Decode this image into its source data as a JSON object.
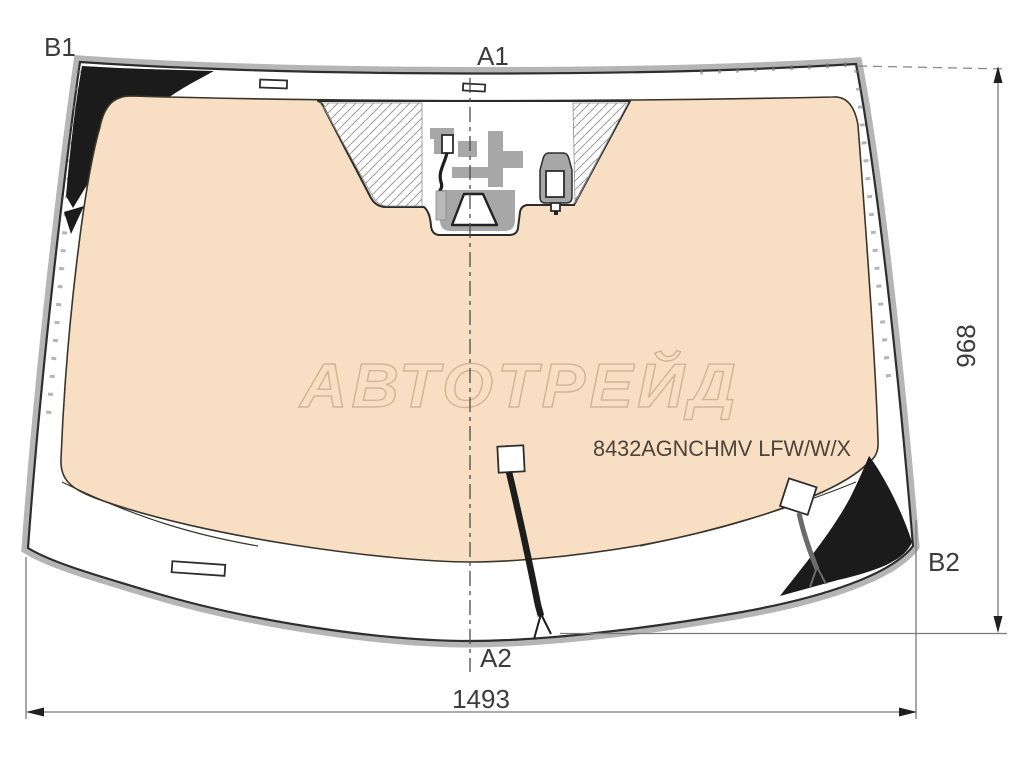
{
  "diagram": {
    "type": "windshield-schematic",
    "labels": {
      "b1": "B1",
      "a1": "A1",
      "a2": "A2",
      "b2": "B2"
    },
    "dimensions": {
      "height_mm": "968",
      "width_mm": "1493"
    },
    "part_number": "8432AGNCHMV LFW/W/X",
    "watermark": "АВТОТРЕЙД",
    "colors": {
      "glass_tint": "#f8dfc3",
      "frit_black": "#1b1b1b",
      "edge_band": "#b5b5b5",
      "bracket_gray": "#a7a7a7",
      "connector_gray": "#b9b9b9"
    }
  }
}
